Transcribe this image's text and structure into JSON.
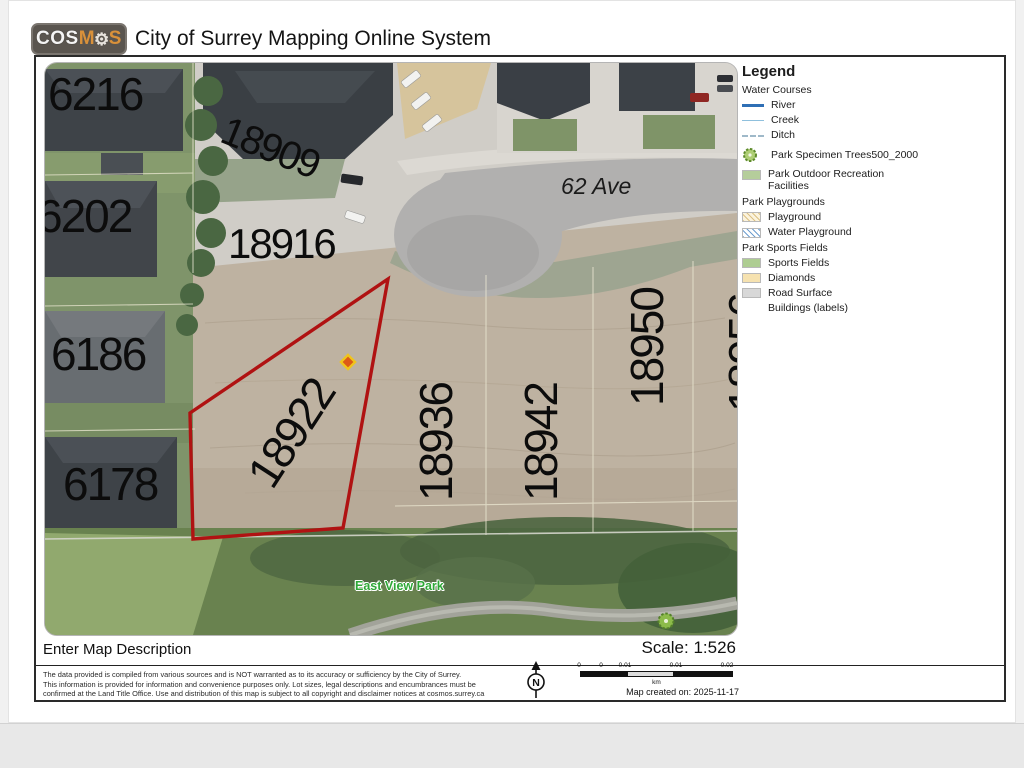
{
  "header": {
    "logo": {
      "cos": "COS",
      "m": "M",
      "gear_icon": "⚙",
      "s": "S"
    },
    "title": "City of Surrey Mapping Online System"
  },
  "legend": {
    "title": "Legend",
    "rows": [
      {
        "label": "Water Courses",
        "kind": "group"
      },
      {
        "label": "River",
        "kind": "line",
        "color": "#2f6fb5"
      },
      {
        "label": "Creek",
        "kind": "line",
        "color": "#8fc0dd"
      },
      {
        "label": "Ditch",
        "kind": "dashed-line",
        "color": "#9fb9c9"
      },
      {
        "label": "Park Specimen Trees500_2000",
        "kind": "tree-icon"
      },
      {
        "label": "Park Outdoor Recreation Facilities",
        "kind": "swatch",
        "color": "#b5cd9b"
      },
      {
        "label": "Park Playgrounds",
        "kind": "group"
      },
      {
        "label": "Playground",
        "kind": "hatch",
        "color": "#fbf3dd"
      },
      {
        "label": "Water Playground",
        "kind": "hatch",
        "color": "#6f9fd0"
      },
      {
        "label": "Park Sports Fields",
        "kind": "group"
      },
      {
        "label": "Sports Fields",
        "kind": "swatch",
        "color": "#aecd92"
      },
      {
        "label": "Diamonds",
        "kind": "swatch",
        "color": "#f6e2b0"
      },
      {
        "label": "Road Surface",
        "kind": "swatch",
        "color": "#d8d8d8"
      },
      {
        "label": "Buildings (labels)",
        "kind": "none"
      }
    ]
  },
  "map": {
    "labels": [
      {
        "text": "6216"
      },
      {
        "text": "18909"
      },
      {
        "text": "6202"
      },
      {
        "text": "18916"
      },
      {
        "text": "6186"
      },
      {
        "text": "18922"
      },
      {
        "text": "18936"
      },
      {
        "text": "18942"
      },
      {
        "text": "18950"
      },
      {
        "text": "18956"
      },
      {
        "text": "6178"
      },
      {
        "text": "62 Ave"
      },
      {
        "text": "East View Park"
      }
    ],
    "highlighted_parcel": "18922",
    "highlight_outline_color": "#b01212",
    "marker": "diamond"
  },
  "footer": {
    "description": "Enter Map Description",
    "scale": "Scale: 1:526",
    "disclaimer_lines": [
      "The data provided is compiled from various sources and is NOT warranted as to its accuracy or sufficiency by the City of Surrey.",
      "This information is provided for information and convenience purposes only.  Lot sizes, legal descriptions and encumbrances must be",
      "confirmed at the Land Title Office.  Use and distribution of this map is subject to all copyright and disclaimer notices at cosmos.surrey.ca"
    ],
    "north_label": "N",
    "scalebar": {
      "ticks": [
        "0",
        "0",
        "0.01",
        "0.01",
        "0.02"
      ],
      "unit": "km"
    },
    "created": "Map created on: 2025-11-17"
  }
}
